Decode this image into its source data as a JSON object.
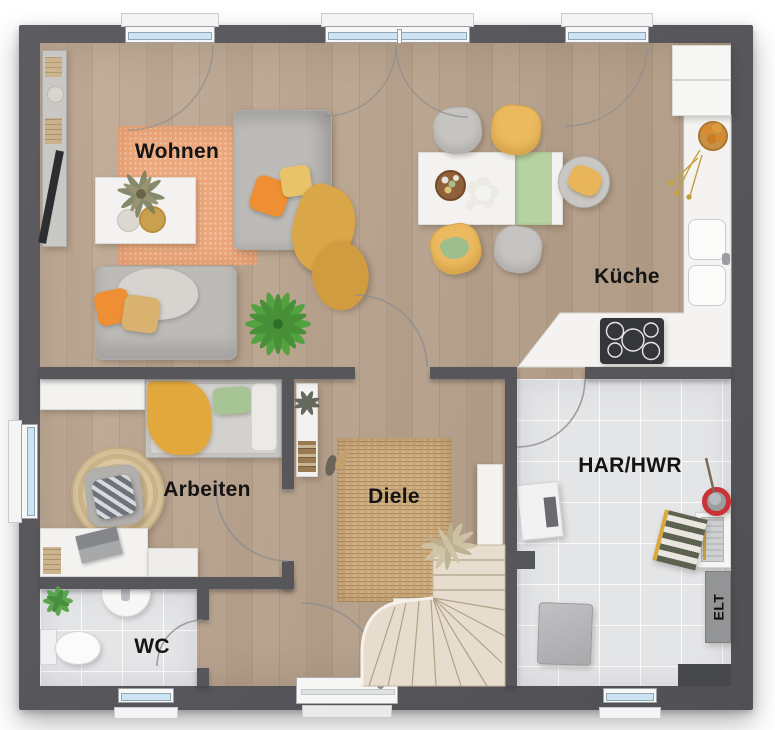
{
  "floorplan": {
    "type": "architectural-floor-plan-top-view",
    "rooms": [
      {
        "id": "wohnen",
        "label": "Wohnen",
        "floor": "wood"
      },
      {
        "id": "kueche",
        "label": "Küche",
        "floor": "wood"
      },
      {
        "id": "arbeiten",
        "label": "Arbeiten",
        "floor": "wood"
      },
      {
        "id": "diele",
        "label": "Diele",
        "floor": "wood"
      },
      {
        "id": "wc",
        "label": "WC",
        "floor": "tile"
      },
      {
        "id": "har_hwr",
        "label": "HAR/HWR",
        "floor": "tile"
      }
    ],
    "panel_labels": {
      "elt": "ELT"
    },
    "palette": {
      "wall": "#57575b",
      "wood_floor": "#d9ccbe",
      "tile_floor": "#e4e5e7",
      "rug_living": "#eca87c",
      "rug_hall": "#c9a87a",
      "accent_orange": "#ef8f33",
      "accent_mustard": "#dba544",
      "accent_yellow_chair": "#ecba5e",
      "accent_green": "#a6c494",
      "runner_green": "#b7d2a2",
      "window_glass": "#cfe4f2",
      "plant_green": "#4aa23a",
      "bucket_red": "#ca3336"
    },
    "furniture": {
      "wohnen": [
        "tv-sideboard",
        "orange-rug",
        "coffee-table",
        "sofa-large",
        "sofa-small",
        "pillows",
        "throw-blanket",
        "palm-plant"
      ],
      "kueche": [
        "dining-table",
        "green-table-runner",
        "six-chairs",
        "kitchen-counter",
        "double-sink",
        "cooktop",
        "fridge",
        "fruit-bowl"
      ],
      "arbeiten": [
        "wall-shelf",
        "daybed",
        "round-rug",
        "office-chair",
        "desk",
        "laptop"
      ],
      "diele": [
        "jute-rug",
        "wall-shelf",
        "shoes",
        "winder-staircase",
        "dried-plant"
      ],
      "wc": [
        "corner-sink",
        "toilet",
        "plant"
      ],
      "har_hwr": [
        "water-heater",
        "washing-machine",
        "laundry-basket",
        "ironing-board-shelf",
        "mop-bucket",
        "electrical-panel"
      ]
    }
  }
}
